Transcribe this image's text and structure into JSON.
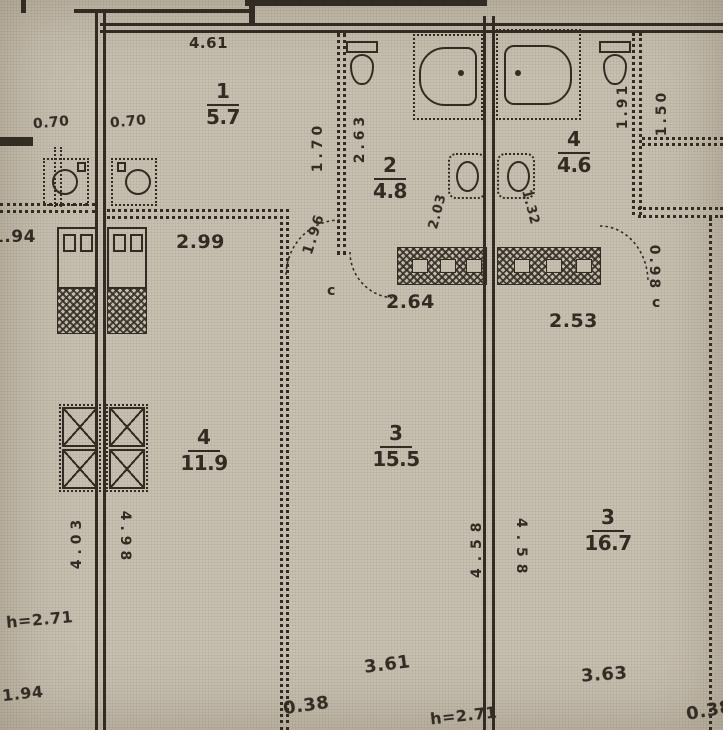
{
  "document_type": "scanned architectural floor plan",
  "colors": {
    "paper": "#cac2b3",
    "ink": "#332d24"
  },
  "rooms": [
    {
      "number": "1",
      "area": "5.7"
    },
    {
      "number": "2",
      "area": "4.8"
    },
    {
      "number": "4",
      "area": "4.6"
    },
    {
      "number": "4",
      "area": "11.9"
    },
    {
      "number": "3",
      "area": "15.5"
    },
    {
      "number": "3",
      "area": "16.7"
    }
  ],
  "dimensions": {
    "horizontal": [
      "4.61",
      "2.99",
      "1.96",
      "2.64",
      "2.53",
      "1.94",
      "3.61",
      "0.38",
      "3.63",
      "0.38",
      "0.70",
      "0.70",
      "2.03",
      "1.32",
      "1.94"
    ],
    "vertical": [
      "1.70",
      "2.63",
      "4.58",
      "4.58",
      "1.91",
      "1.50",
      "0.98",
      "4.03",
      "4.98"
    ]
  },
  "annotations": [
    "h=2.71",
    "h=2.71",
    "c",
    "c"
  ],
  "fixtures": [
    "bathtub",
    "bathtub",
    "toilet",
    "toilet",
    "washbasin",
    "washbasin",
    "kitchen-sink",
    "kitchen-sink",
    "vent-duct",
    "vent-duct",
    "door-swing",
    "door-swing",
    "door-swing"
  ]
}
